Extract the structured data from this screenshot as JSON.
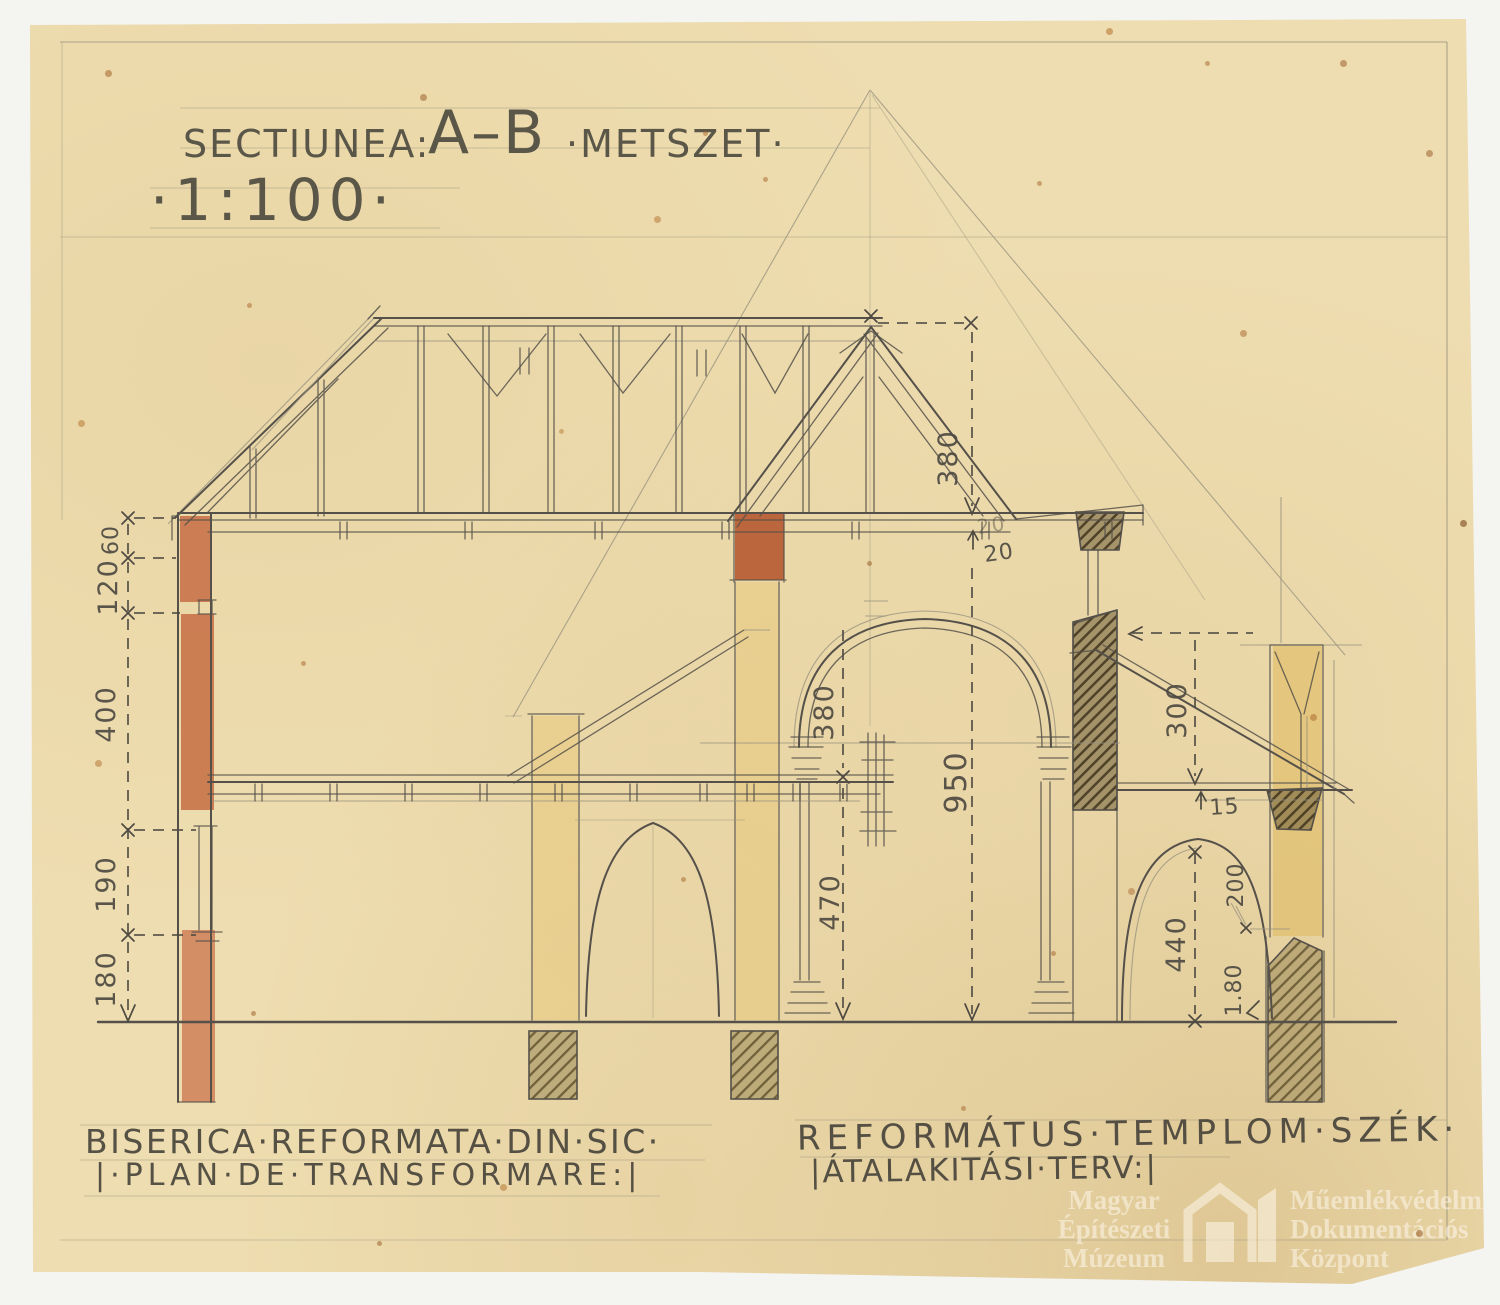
{
  "title": {
    "sectiunea": "SECTIUNEA:",
    "ab": "A–B",
    "metszet": "·METSZET·",
    "scale": "·1:100·"
  },
  "captions": {
    "ro1": "BISERICA·REFORMATA·DIN·SIC·",
    "ro2": "|·PLAN·DE·TRANSFORMARE:|",
    "hu1": "REFORMÁTUS·TEMPLOM·SZÉK·",
    "hu2": "|ÁTALAKITÁSI·TERV:|"
  },
  "dims": {
    "roof_height": "380",
    "eaves_a": "20",
    "eaves_b": "20",
    "left": [
      "60",
      "120",
      "400",
      "190",
      "180"
    ],
    "nave_upper": "380",
    "nave_lower": "470",
    "nave_total": "950",
    "aisle_height": "300",
    "beam_depth": "15",
    "aisle_arch": "440",
    "aisle_a": "200",
    "aisle_b": "1.80"
  },
  "watermark": {
    "museum": [
      "Magyar",
      "Építészeti",
      "Múzeum"
    ],
    "center": [
      "Műemlékvédelmi",
      "Dokumentációs",
      "Központ"
    ]
  },
  "colors": {
    "paper": "#eeddb0",
    "pencil": "#55514a",
    "faint": "#9a947f",
    "red": "#c4693f",
    "yellow": "#e7c87b",
    "dash": "#4e4a42",
    "bg": "#f4f4f1"
  }
}
